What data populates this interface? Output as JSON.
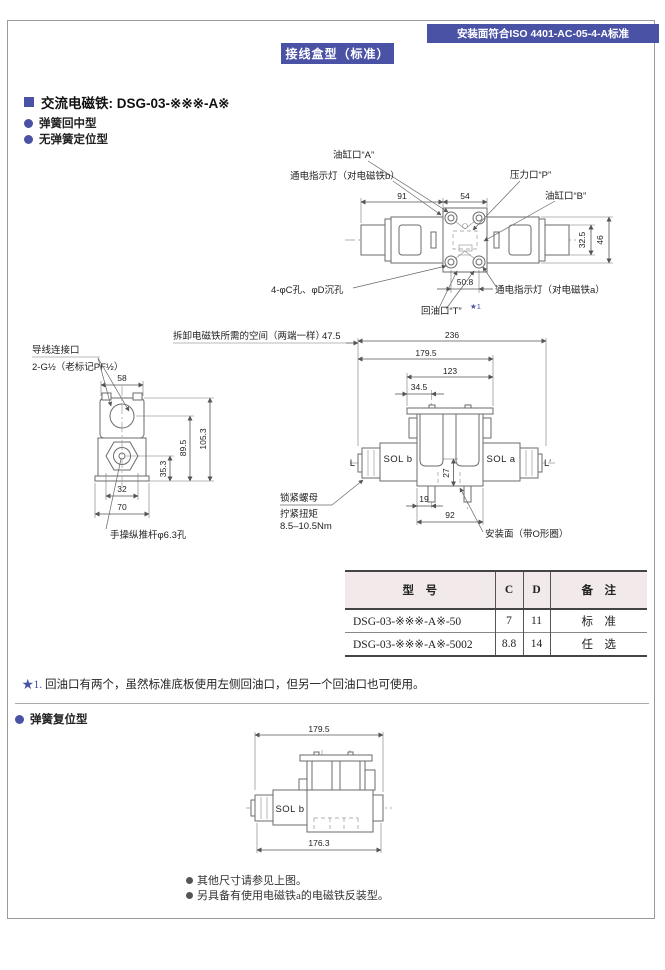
{
  "colors": {
    "accent": "#4a52a5",
    "tableHeaderBg": "#f2eaea",
    "pageBorder": "#9a9a9a"
  },
  "banners": {
    "iso": "安装面符合ISO 4401-AC-05-4-A标准",
    "section": "接线盒型（标准）"
  },
  "intro": {
    "heading": "交流电磁铁: DSG-03-※※※-A※",
    "bullet1": "弹簧回中型",
    "bullet2": "无弹簧定位型"
  },
  "topView": {
    "portA": "油缸口“A”",
    "lampB": "通电指示灯（对电磁铁b）",
    "portP": "压力口“P”",
    "portB": "油缸口“B”",
    "holes": "4-φC孔、φD沉孔",
    "lampA": "通电指示灯（对电磁铁a）",
    "portT": "回油口“T”",
    "portTSup": "★1",
    "dim91": "91",
    "dim54": "54",
    "dim325": "32.5",
    "dim46": "46",
    "dim508": "50.8"
  },
  "sideView": {
    "conduit1": "导线连接口",
    "conduit2": "2-G½（老标记PF½）",
    "pushRod": "手操纵推杆φ6.3孔",
    "dim58": "58",
    "dim895": "89.5",
    "dim1053": "105.3",
    "dim353": "35.3",
    "dim32": "32",
    "dim70": "70"
  },
  "frontView": {
    "removalNote": "拆卸电磁铁所需的空间（两端一样）",
    "dim475": "47.5",
    "dim236": "236",
    "dim1795": "179.5",
    "dim123": "123",
    "dim345": "34.5",
    "dim27": "27",
    "dim19": "19",
    "dim92": "92",
    "labelL": "L",
    "labelLp": "L′",
    "solB": "SOL b",
    "solA": "SOL a",
    "lockNut": "锁紧螺母",
    "torque1": "拧紧扭矩",
    "torque2": "8.5–10.5Nm",
    "mountFace": "安装面（带O形圈）"
  },
  "table": {
    "headers": [
      "型　号",
      "C",
      "D",
      "备　注"
    ],
    "rows": [
      [
        "DSG-03-※※※-A※-50",
        "7",
        "11",
        "标　准"
      ],
      [
        "DSG-03-※※※-A※-5002",
        "8.8",
        "14",
        "任　选"
      ]
    ]
  },
  "footnote": {
    "marker": "★1.",
    "text": "回油口有两个，虽然标准底板使用左侧回油口，但另一个回油口也可使用。"
  },
  "spring": {
    "heading": "弹簧复位型",
    "dim1795": "179.5",
    "dim1763": "176.3",
    "solB": "SOL b",
    "note1": "其他尺寸请参见上图。",
    "note2": "另具备有使用电磁铁a的电磁铁反装型。"
  }
}
